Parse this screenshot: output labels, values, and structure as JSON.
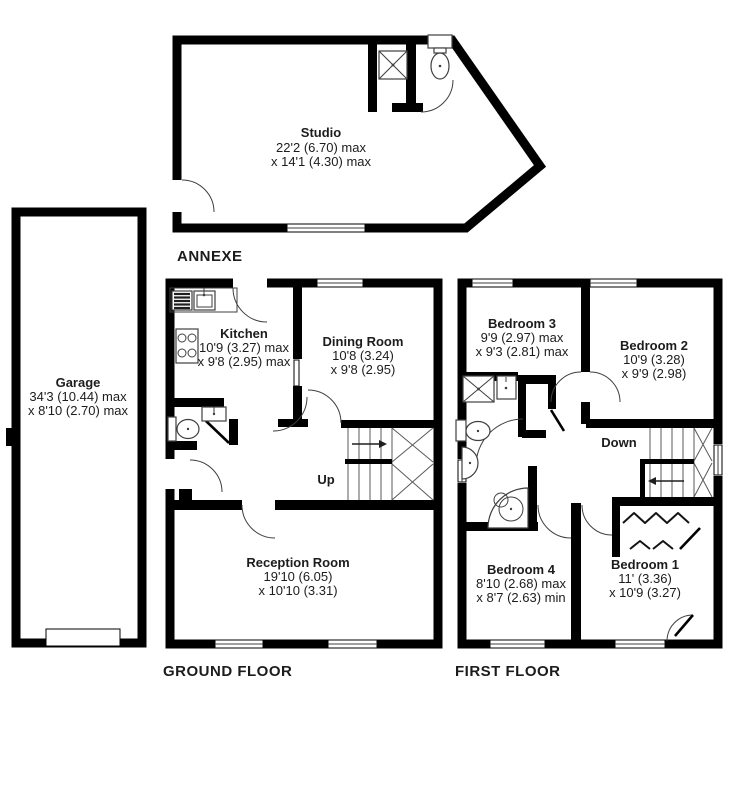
{
  "plan": {
    "annexe": {
      "label": "ANNEXE",
      "studio": {
        "name": "Studio",
        "dim1": "22'2 (6.70) max",
        "dim2": "x 14'1 (4.30) max"
      }
    },
    "garage": {
      "name": "Garage",
      "dim1": "34'3 (10.44) max",
      "dim2": "x 8'10 (2.70) max"
    },
    "ground_floor": {
      "label": "GROUND FLOOR",
      "stairs": "Up",
      "kitchen": {
        "name": "Kitchen",
        "dim1": "10'9 (3.27) max",
        "dim2": "x 9'8 (2.95) max"
      },
      "dining": {
        "name": "Dining Room",
        "dim1": "10'8 (3.24)",
        "dim2": "x 9'8 (2.95)"
      },
      "reception": {
        "name": "Reception Room",
        "dim1": "19'10 (6.05)",
        "dim2": "x 10'10 (3.31)"
      }
    },
    "first_floor": {
      "label": "FIRST FLOOR",
      "stairs": "Down",
      "bedroom1": {
        "name": "Bedroom 1",
        "dim1": "11' (3.36)",
        "dim2": "x 10'9 (3.27)"
      },
      "bedroom2": {
        "name": "Bedroom 2",
        "dim1": "10'9 (3.28)",
        "dim2": "x 9'9 (2.98)"
      },
      "bedroom3": {
        "name": "Bedroom 3",
        "dim1": "9'9 (2.97) max",
        "dim2": "x 9'3 (2.81) max"
      },
      "bedroom4": {
        "name": "Bedroom 4",
        "dim1": "8'10 (2.68) max",
        "dim2": "x 8'7 (2.63) min"
      }
    }
  },
  "colors": {
    "wall": "#000000",
    "line": "#3f3f3f",
    "text": "#1c1c1c",
    "background": "#ffffff"
  }
}
